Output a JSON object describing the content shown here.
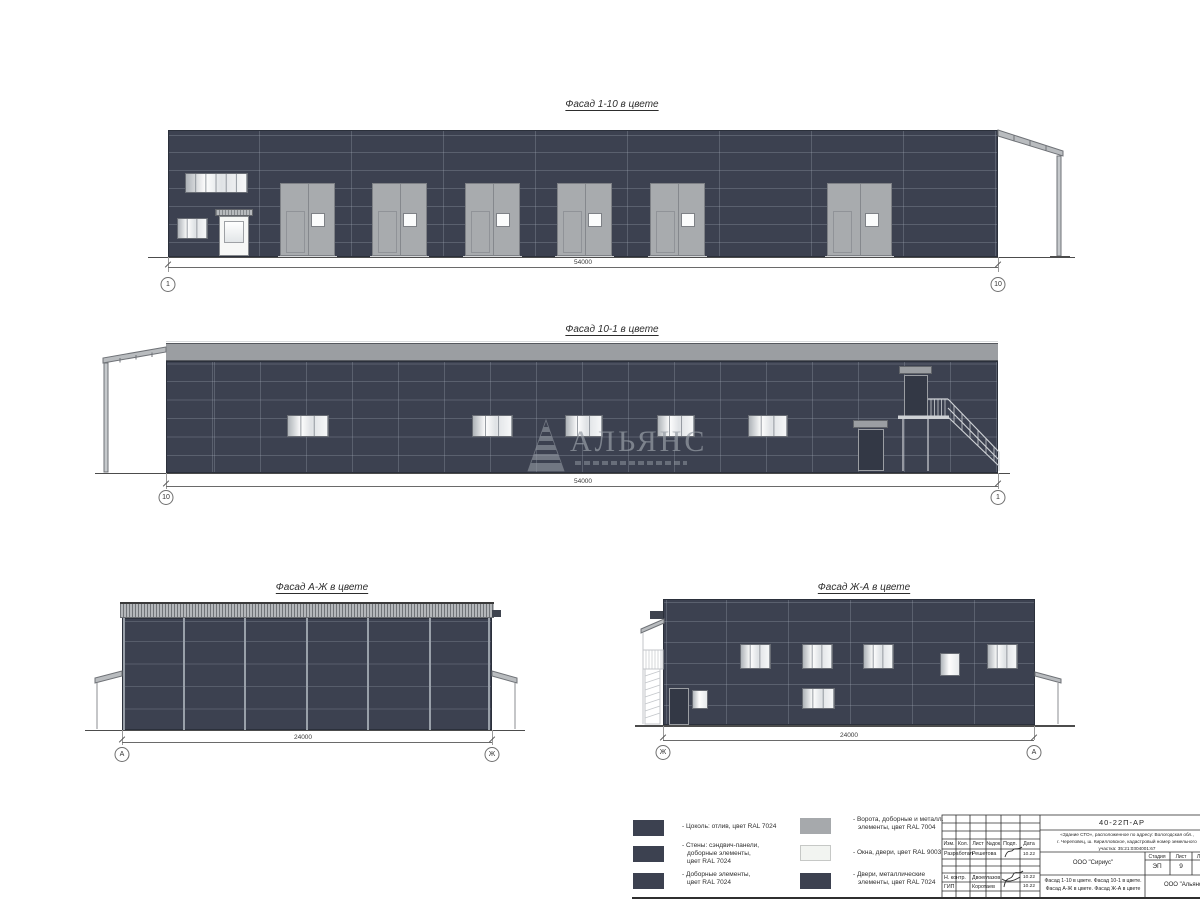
{
  "facades": {
    "f110": {
      "title": "Фасад 1-10 в цвете",
      "dim": "54000",
      "axis_left": "1",
      "axis_right": "10"
    },
    "f101": {
      "title": "Фасад 10-1 в цвете",
      "dim": "54000",
      "axis_left": "10",
      "axis_right": "1"
    },
    "fazh": {
      "title": "Фасад А-Ж в цвете",
      "dim": "24000",
      "axis_left": "А",
      "axis_right": "Ж"
    },
    "fzha": {
      "title": "Фасад Ж-А в цвете",
      "dim": "24000",
      "axis_left": "Ж",
      "axis_right": "А"
    }
  },
  "watermark": {
    "text": "АЛЬЯНС"
  },
  "palette": {
    "wall": "#3c4150",
    "metal": "#a6a9ac",
    "white": "#f2f4f1"
  },
  "legend": {
    "items": [
      {
        "swatch": "#3c4150",
        "lines": [
          "- Цоколь: отлив, цвет RAL 7024"
        ]
      },
      {
        "swatch": "#3c4150",
        "lines": [
          "- Стены: сэндвич-панели,",
          "доборные элементы,",
          "цвет RAL 7024"
        ]
      },
      {
        "swatch": "#3c4150",
        "lines": [
          "- Доборные элементы,",
          "цвет RAL 7024"
        ]
      },
      {
        "swatch": "#a6a9ac",
        "lines": [
          "- Ворота, доборные и металл.",
          "элементы, цвет RAL 7004"
        ]
      },
      {
        "swatch": "#f2f4f1",
        "lines": [
          "- Окна, двери, цвет RAL 9003"
        ]
      },
      {
        "swatch": "#3c4150",
        "lines": [
          "- Двери, металлические",
          "элементы, цвет RAL 7024"
        ]
      }
    ]
  },
  "titleblock": {
    "doc_number": "40-22П-АР",
    "address_lines": [
      "«Здание СТО», расположенное по адресу: Вологодская обл.,",
      "г. Череповец, ш. Кирилловское, кадастровый номер земельного",
      "участка: 35:21:0304001:67"
    ],
    "org": "ООО \"Сириус\"",
    "company": "ООО \"Альянс\"",
    "stage_label": "Стадия",
    "sheet_label": "Лист",
    "sheets_label": "Листов",
    "stage": "ЭП",
    "sheet_no": "9",
    "content_lines": [
      "Фасад 1-10 в цвете. Фасад 10-1 в цвете.",
      "Фасад А-Ж в цвете. Фасад Ж-А в цвете"
    ],
    "cols": [
      "Изм.",
      "Кол.",
      "Лист",
      "№док.",
      "Подп.",
      "Дата"
    ],
    "rows": [
      {
        "role": "Разработал",
        "name": "Решетова",
        "date": "10.22"
      },
      {
        "role": "Н. контр.",
        "name": "Двоеглазов",
        "date": "10.22"
      },
      {
        "role": "ГИП",
        "name": "Коротаев",
        "date": "10.22"
      }
    ]
  }
}
